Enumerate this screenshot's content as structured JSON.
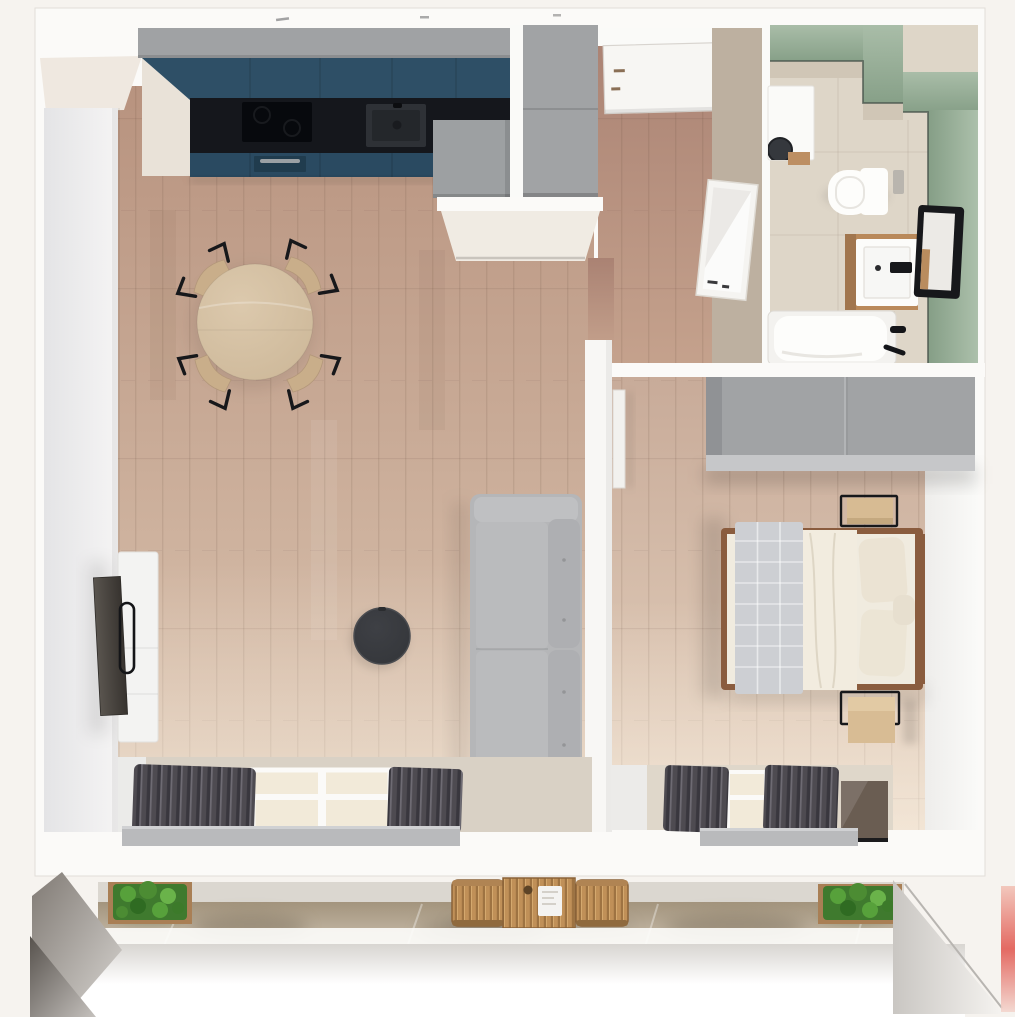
{
  "meta": {
    "scene": "3d-apartment-floor-plan-top-view",
    "style": "photorealistic dollhouse render, top-down camera",
    "visible_text": "none"
  },
  "colors": {
    "background": "#f6f3ef",
    "shell_white": "#fbfaf8",
    "wall_face_gray": "#e6e6e8",
    "cream_wall": "#f0ebe3",
    "wood_floor_dark": "#b8937f",
    "wood_floor_light": "#dcc6b2",
    "hall_floor_dark": "#aa8273",
    "hall_floor_light": "#c5a28d",
    "bed_floor_dark": "#c8ab99",
    "bed_floor_light": "#e5d2bf",
    "kitchen_upper_teal": "#2e4f66",
    "kitchen_base_teal": "#2a4a61",
    "countertop_black": "#15171c",
    "cabinet_gray": "#a0a2a4",
    "wardrobe_gray": "#a1a3a5",
    "hall_wall_beige": "#c9bcab",
    "bath_green_light": "#a9bda8",
    "bath_green_dark": "#87a088",
    "bath_floor_beige": "#ded6c8",
    "bath_tile_beige": "#d0c6b6",
    "fixture_white": "#fdfdfb",
    "vanity_wood": "#b9895a",
    "frame_black": "#17181b",
    "sofa_gray": "#b5b6b8",
    "cushion_gray": "#aeafb2",
    "curtain_dark": "#4e4b51",
    "sill_gray": "#b9babc",
    "dining_table_wood": "#cdb899",
    "chair_wood": "#c9ae8a",
    "coffee_table_dark": "#34363a",
    "tv_cabinet_white": "#f3f3f2",
    "tv_screen_dark": "#4a443e",
    "bed_frame_wood": "#8a5c3e",
    "duvet_cream": "#f0ebdf",
    "quilt_gray": "#cdcfd3",
    "pillow_cream": "#ebe3d3",
    "nightstand_wood": "#d7bb93",
    "balcony_table_wood": "#c09058",
    "plant_green": "#4c8c33",
    "planter_wood": "#a97f55",
    "railing_white": "#ffffff",
    "glass_warm": "#f2ead9",
    "window_frame_white": "#fbfaf8",
    "dark_glass_brown": "#6a5d52",
    "red_edge_artifact": "#e0524a"
  },
  "rooms": [
    {
      "id": "living-room-kitchen",
      "label": "Open-plan living room with kitchen",
      "furniture": [
        "teal kitchen cabinets",
        "black countertop",
        "induction cooktop",
        "kitchen sink",
        "oven",
        "tall fridge cabinet",
        "round dining table",
        "4 dining chairs",
        "gray two-seat sofa",
        "round black coffee table",
        "white tv sideboard",
        "wall tv",
        "balcony window with gray curtains"
      ]
    },
    {
      "id": "hallway",
      "label": "Entrance hallway",
      "furniture": [
        "entrance door",
        "tall gray cabinet",
        "leaning mirror",
        "beige accent wall"
      ]
    },
    {
      "id": "bathroom",
      "label": "Bathroom with sage green walls",
      "furniture": [
        "washing machine",
        "wall-hung toilet",
        "wood vanity with washbasin",
        "black framed mirror",
        "bathtub with black fittings"
      ]
    },
    {
      "id": "bedroom",
      "label": "Bedroom",
      "furniture": [
        "double bed with wood frame",
        "gray quilted runner",
        "pillows",
        "2 oak nightstands with black frames",
        "gray wardrobe",
        "window with gray curtains"
      ]
    },
    {
      "id": "balcony",
      "label": "Balcony",
      "furniture": [
        "2 green planter boxes",
        "wooden bistro table",
        "2 wooden chairs",
        "white railing"
      ]
    }
  ],
  "counts": {
    "rooms": 5,
    "dining_chairs": 4,
    "nightstands": 2,
    "planters": 2,
    "balcony_chairs": 2,
    "sofa_seats": 2
  }
}
